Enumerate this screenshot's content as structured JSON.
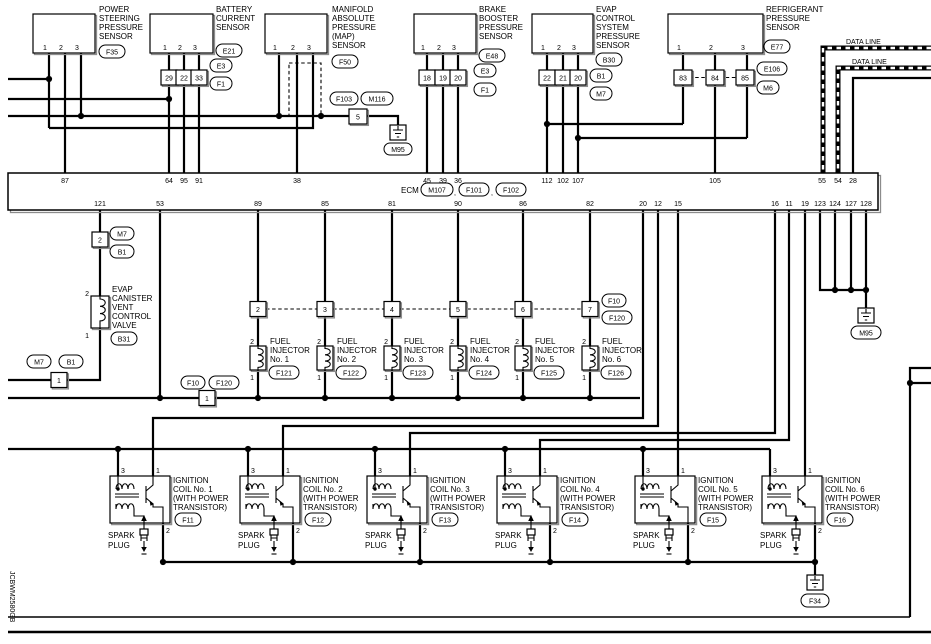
{
  "diagram_code": "JCBWM2580GB",
  "data_line_label": "DATA LINE",
  "comma": ",",
  "colors": {
    "line": "#000000",
    "background": "#ffffff",
    "shadow": "#8c8c8c"
  },
  "sensors": [
    {
      "lines": [
        "POWER",
        "STEERING",
        "PRESSURE",
        "SENSOR"
      ],
      "id": "F35",
      "p1": "1",
      "p2": "2",
      "p3": "3"
    },
    {
      "lines": [
        "BATTERY",
        "CURRENT",
        "SENSOR"
      ],
      "id": "E21",
      "p1": "1",
      "p2": "2",
      "p3": "3",
      "t1": "29",
      "t2": "22",
      "t3": "33",
      "tagA": "E3",
      "tagB": "F1"
    },
    {
      "lines": [
        "MANIFOLD",
        "ABSOLUTE",
        "PRESSURE",
        "(MAP)",
        "SENSOR"
      ],
      "id": "F50",
      "p1": "1",
      "p2": "2",
      "p3": "3"
    },
    {
      "lines": [
        "BRAKE",
        "BOOSTER",
        "PRESSURE",
        "SENSOR"
      ],
      "id": "E48",
      "p1": "1",
      "p2": "2",
      "p3": "3",
      "t1": "18",
      "t2": "19",
      "t3": "20",
      "tagA": "E3",
      "tagB": "F1"
    },
    {
      "lines": [
        "EVAP",
        "CONTROL",
        "SYSTEM",
        "PRESSURE",
        "SENSOR"
      ],
      "id": "B30",
      "p1": "1",
      "p2": "2",
      "p3": "3",
      "t1": "22",
      "t2": "21",
      "t3": "20",
      "tagA": "B1",
      "tagB": "M7"
    },
    {
      "lines": [
        "REFRIGERANT",
        "PRESSURE",
        "SENSOR"
      ],
      "id": "E77",
      "p1": "1",
      "p2": "2",
      "p3": "3",
      "t1": "83",
      "t2": "84",
      "t3": "85",
      "tagA": "E106",
      "tagB": "M6"
    }
  ],
  "inline_connector": {
    "tag_a": "F103",
    "tag_b": "M116",
    "terminal": "5",
    "ground": "M95"
  },
  "ecm": {
    "name": "ECM",
    "c1": "M107",
    "c2": "F101",
    "c3": "F102",
    "top": [
      "87",
      "64",
      "95",
      "91",
      "38",
      "45",
      "39",
      "36",
      "112",
      "102",
      "107",
      "105",
      "55",
      "54",
      "28"
    ],
    "bottom": [
      "121",
      "53",
      "89",
      "85",
      "81",
      "90",
      "86",
      "82",
      "20",
      "12",
      "15",
      "16",
      "11",
      "19",
      "123",
      "124",
      "127",
      "128"
    ]
  },
  "valve": {
    "lines": [
      "EVAP",
      "CANISTER",
      "VENT",
      "CONTROL",
      "VALVE"
    ],
    "id": "B31",
    "pt": "2",
    "pb": "1",
    "term_u": "2",
    "term_l": "1",
    "tagA": "M7",
    "tagB": "B1"
  },
  "injector_feed": {
    "terminal": "1",
    "tag_a": "F10",
    "tag_b": "F120"
  },
  "injector_link": {
    "tag_a": "F10",
    "tag_b": "F120"
  },
  "injectors": [
    {
      "term": "2",
      "lines": [
        "FUEL",
        "INJECTOR",
        "No. 1"
      ],
      "id": "F121",
      "pt": "2",
      "pb": "1"
    },
    {
      "term": "3",
      "lines": [
        "FUEL",
        "INJECTOR",
        "No. 2"
      ],
      "id": "F122",
      "pt": "2",
      "pb": "1"
    },
    {
      "term": "4",
      "lines": [
        "FUEL",
        "INJECTOR",
        "No. 3"
      ],
      "id": "F123",
      "pt": "2",
      "pb": "1"
    },
    {
      "term": "5",
      "lines": [
        "FUEL",
        "INJECTOR",
        "No. 4"
      ],
      "id": "F124",
      "pt": "2",
      "pb": "1"
    },
    {
      "term": "6",
      "lines": [
        "FUEL",
        "INJECTOR",
        "No. 5"
      ],
      "id": "F125",
      "pt": "2",
      "pb": "1"
    },
    {
      "term": "7",
      "lines": [
        "FUEL",
        "INJECTOR",
        "No. 6"
      ],
      "id": "F126",
      "pt": "2",
      "pb": "1"
    }
  ],
  "grounds": {
    "m95_top": "M95",
    "m95_right": "M95",
    "f34": "F34"
  },
  "coils": [
    {
      "lines": [
        "IGNITION",
        "COIL No. 1",
        "(WITH POWER",
        "TRANSISTOR)"
      ],
      "id": "F11",
      "p3": "3",
      "p1": "1",
      "p2": "2",
      "plug": [
        "SPARK",
        "PLUG"
      ]
    },
    {
      "lines": [
        "IGNITION",
        "COIL No. 2",
        "(WITH POWER",
        "TRANSISTOR)"
      ],
      "id": "F12",
      "p3": "3",
      "p1": "1",
      "p2": "2",
      "plug": [
        "SPARK",
        "PLUG"
      ]
    },
    {
      "lines": [
        "IGNITION",
        "COIL No. 3",
        "(WITH POWER",
        "TRANSISTOR)"
      ],
      "id": "F13",
      "p3": "3",
      "p1": "1",
      "p2": "2",
      "plug": [
        "SPARK",
        "PLUG"
      ]
    },
    {
      "lines": [
        "IGNITION",
        "COIL No. 4",
        "(WITH POWER",
        "TRANSISTOR)"
      ],
      "id": "F14",
      "p3": "3",
      "p1": "1",
      "p2": "2",
      "plug": [
        "SPARK",
        "PLUG"
      ]
    },
    {
      "lines": [
        "IGNITION",
        "COIL No. 5",
        "(WITH POWER",
        "TRANSISTOR)"
      ],
      "id": "F15",
      "p3": "3",
      "p1": "1",
      "p2": "2",
      "plug": [
        "SPARK",
        "PLUG"
      ]
    },
    {
      "lines": [
        "IGNITION",
        "COIL No. 6",
        "(WITH POWER",
        "TRANSISTOR)"
      ],
      "id": "F16",
      "p3": "3",
      "p1": "1",
      "p2": "2",
      "plug": [
        "SPARK",
        "PLUG"
      ]
    }
  ]
}
